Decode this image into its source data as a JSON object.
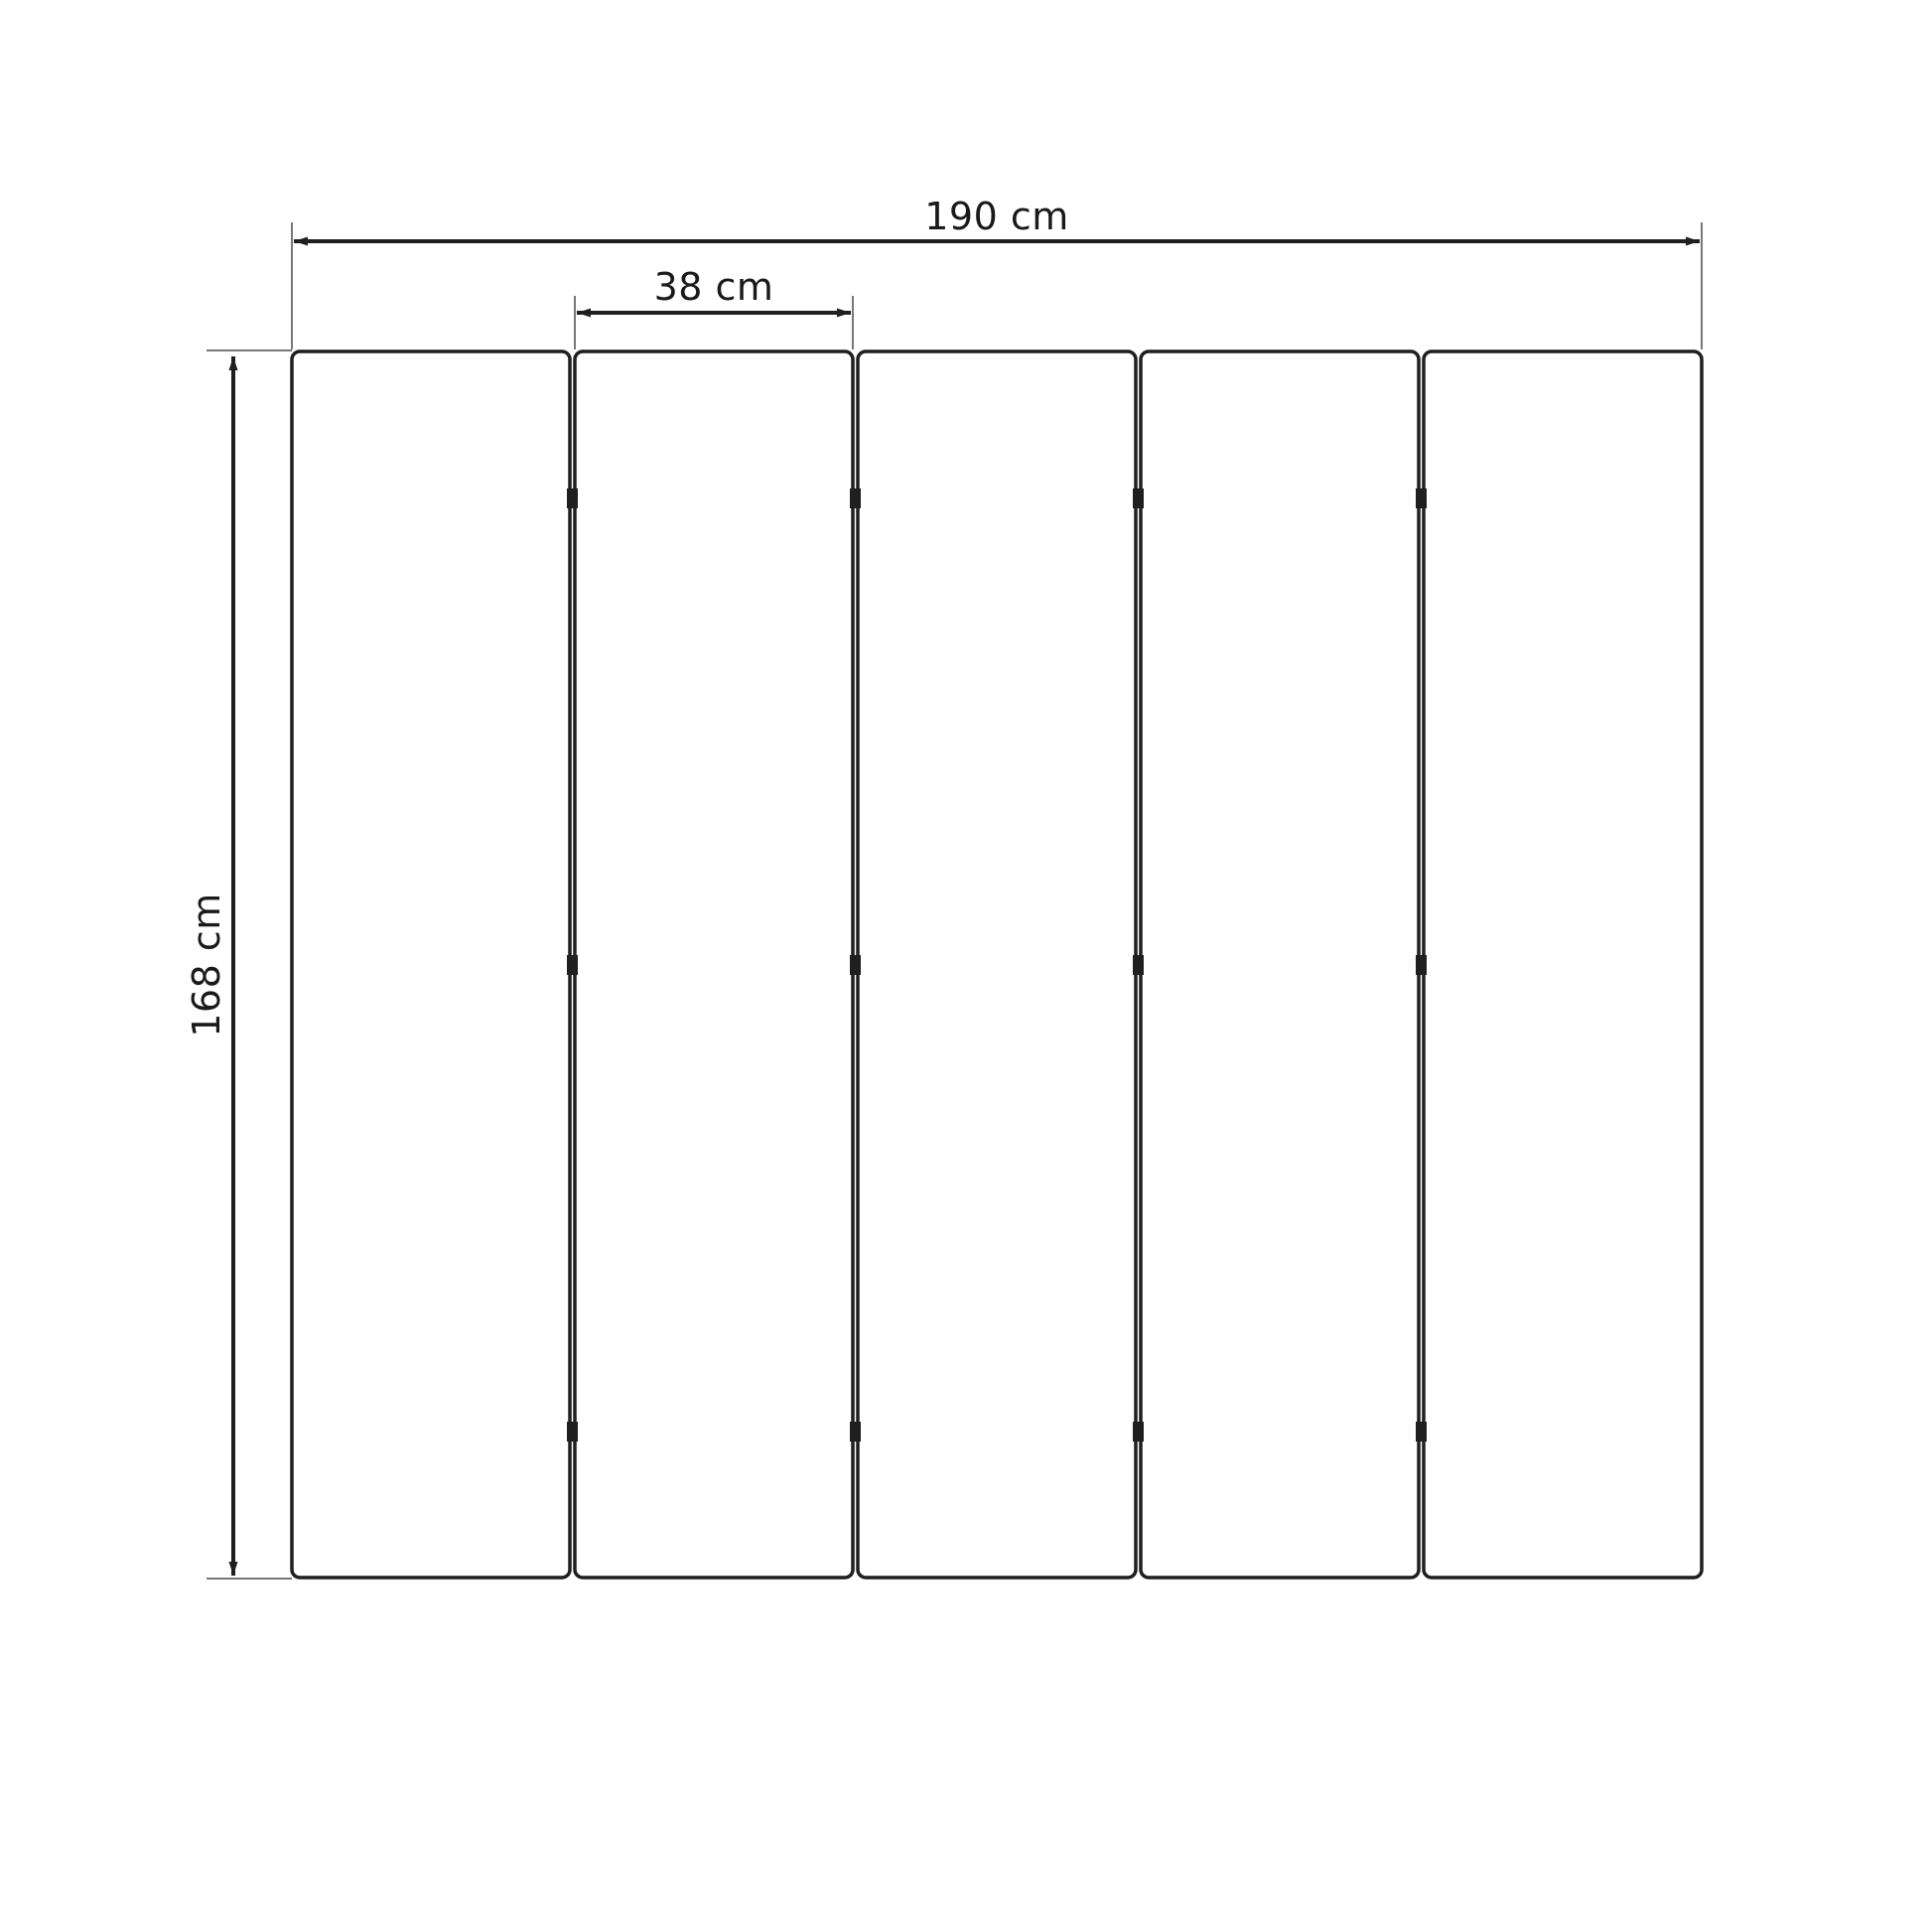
{
  "diagram": {
    "panel_count": 5,
    "hinge_rows_per_gap": 3,
    "dimensions": {
      "total_width": {
        "label": "190 cm",
        "value_cm": 190
      },
      "panel_width": {
        "label": "38 cm",
        "value_cm": 38
      },
      "height": {
        "label": "168 cm",
        "value_cm": 168
      }
    },
    "colors": {
      "line": "#1f1f1f",
      "extension_line": "#4a4a4a",
      "text": "#1a1a1a",
      "panel_fill": "#ffffff",
      "background": "#ffffff"
    }
  }
}
